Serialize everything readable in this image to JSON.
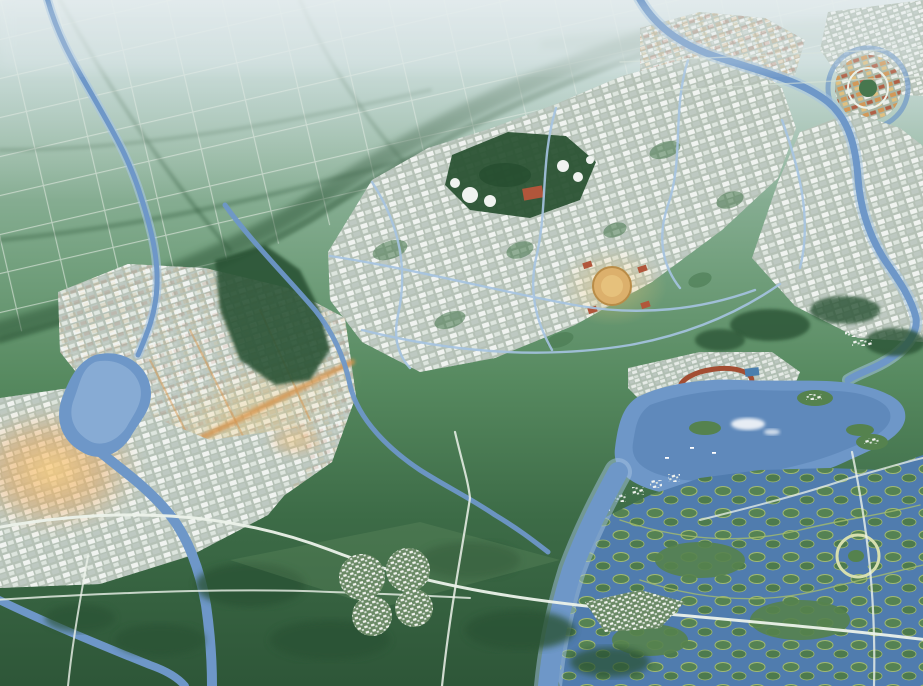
{
  "meta": {
    "title": "Aerial master-plan rendering of a planned riverside eco-city",
    "view": "bird's-eye perspective render, no visible text or UI chrome"
  },
  "palette": {
    "hazeTop": "#bdced1",
    "hazeMid": "#a6c3ba",
    "fieldFar": "#8ab094",
    "fieldMid": "#5d8c63",
    "fieldDark": "#30583a",
    "forest": "#2b5334",
    "forestLight": "#47774e",
    "water": "#6e97c8",
    "waterLight": "#a6c4e2",
    "waterDeep": "#507cae",
    "road": "#ecf2ea",
    "roadFaint": "#d7e3d7",
    "cityBase": "#b5c1b6",
    "blockWhite": "#f0f3f0",
    "blockLight": "#dde5de",
    "blockGray": "#bec9c2",
    "villageWhite": "#f4f6f2",
    "accentOrange": "#d6954f",
    "accentRed": "#b1563b",
    "accentGold": "#e6c17c",
    "glow": "#f3b258",
    "plazaGold": "#dcb06c",
    "wetland": "#55824e",
    "wetlandEdge": "#a4bc6d",
    "trackRed": "#a34e33",
    "roofBlue": "#4a7fae"
  },
  "scene": {
    "regions": [
      {
        "id": "farmland-north",
        "label": "Hazy gridded farmland with tree hedgerows"
      },
      {
        "id": "district-central",
        "label": "Dense mid-rise city blocks laced with canals"
      },
      {
        "id": "district-east",
        "label": "Eastern city blocks toward the river"
      },
      {
        "id": "district-west",
        "label": "Western district with orange-lit boulevard"
      },
      {
        "id": "district-southwest",
        "label": "White block district in warm sunset glow"
      },
      {
        "id": "district-northeast",
        "label": "Suburban villages with red roofs"
      },
      {
        "id": "ring-village",
        "label": "Circular canal-ringed village"
      },
      {
        "id": "central-park",
        "label": "Park with white dome pavilions and red hall"
      },
      {
        "id": "golden-plaza",
        "label": "Circular golden civic plaza"
      },
      {
        "id": "lakefront",
        "label": "Lakefront strip with red oval track"
      },
      {
        "id": "central-lake",
        "label": "Large lake with islands, boats and cloud reflections"
      },
      {
        "id": "wetland-park",
        "label": "Wetland maze of green islets"
      },
      {
        "id": "circular-pond",
        "label": "Ring-shaped pond landmark"
      },
      {
        "id": "flower-village",
        "label": "Clover-shaped village cluster"
      },
      {
        "id": "south-village",
        "label": "Roadside village in the southern fields"
      },
      {
        "id": "rivers",
        "label": "Winding blue rivers and canals"
      },
      {
        "id": "roads",
        "label": "Pale country roads and southern highway"
      }
    ]
  }
}
